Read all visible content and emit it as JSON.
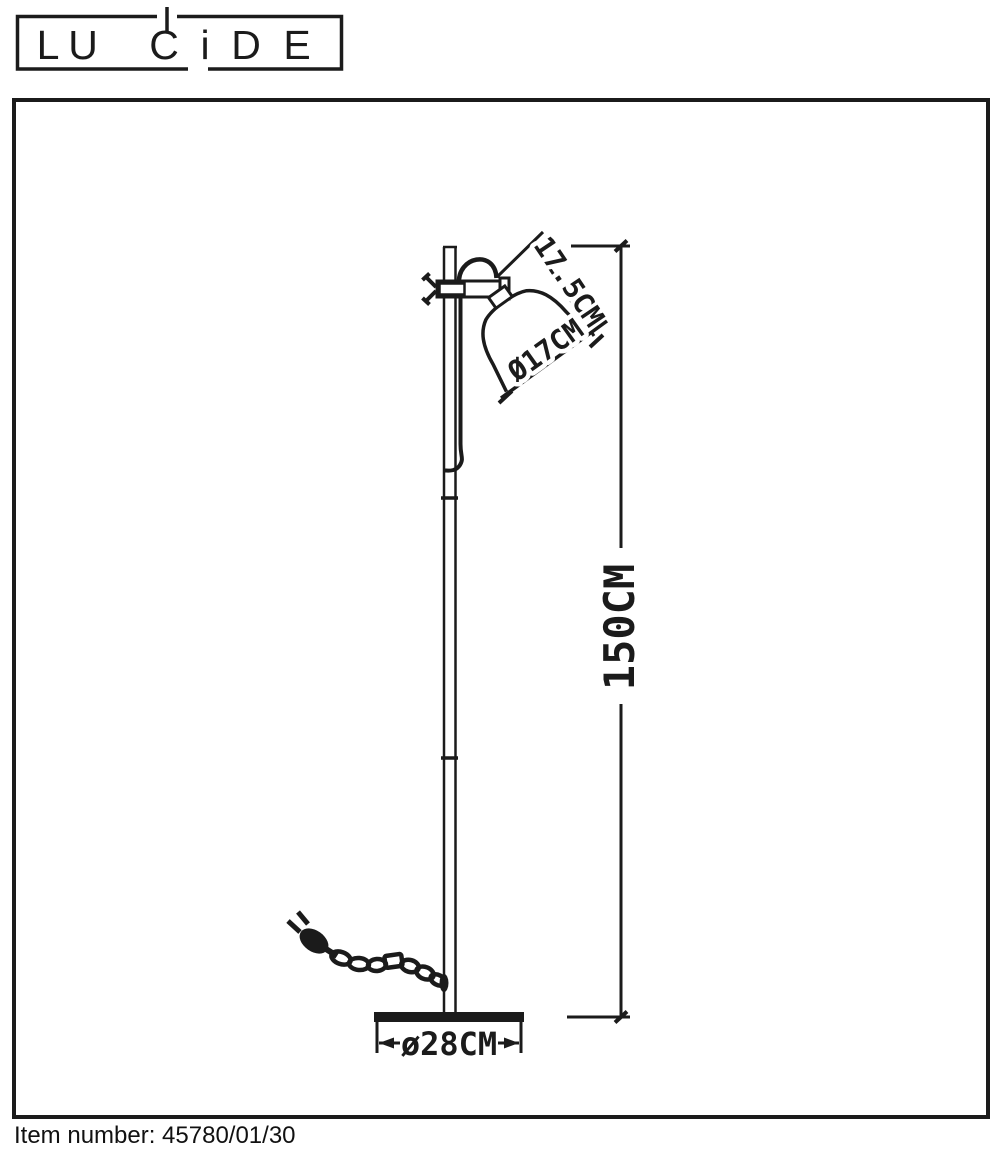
{
  "page": {
    "background": "#ffffff",
    "line_color": "#1b1b1b"
  },
  "brand_logo": {
    "name": "LUCIDE",
    "letters": [
      "L",
      "U",
      "C",
      "i",
      "D",
      "E"
    ]
  },
  "diagram": {
    "subject": "floor lamp technical drawing",
    "dimensions": {
      "shade_height": "17.5CM",
      "shade_diameter": "Ø17CM",
      "lamp_height": "150CM",
      "base_diameter": "ø28CM"
    }
  },
  "footer": {
    "item_number": "Item number: 45780/01/30"
  }
}
